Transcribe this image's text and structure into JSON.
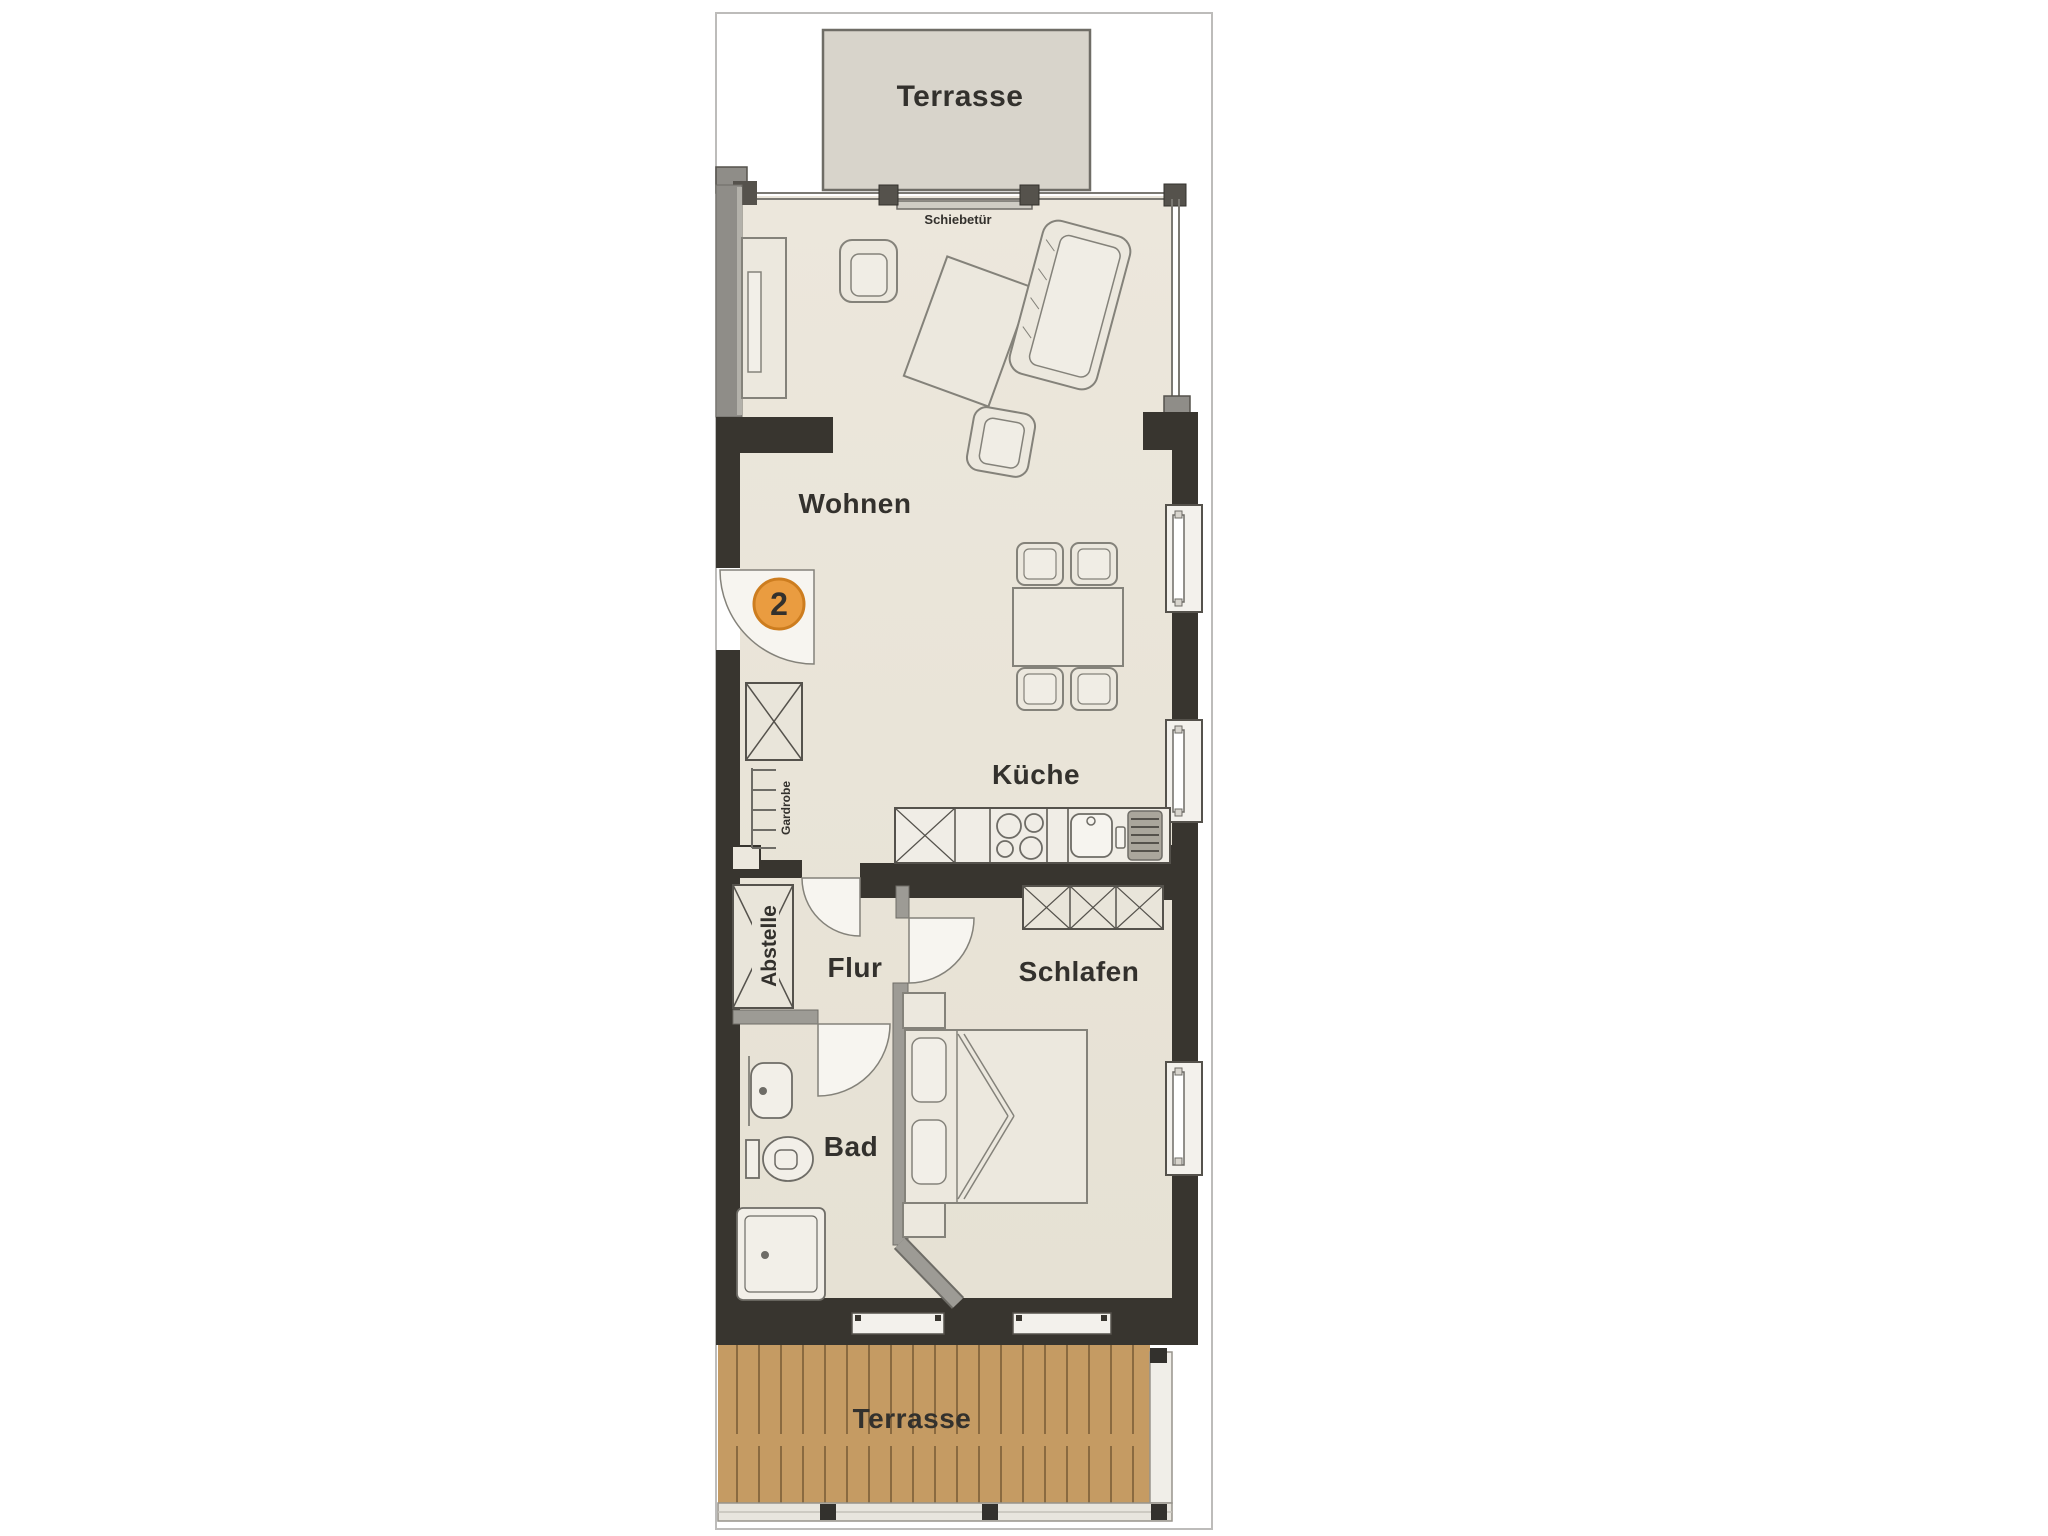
{
  "palette": {
    "wall_dark": "#38352f",
    "wall_gray": "#8f8d88",
    "partition_gray": "#9d9b95",
    "floor_cream": "#eae5da",
    "terrace_gray": "#d8d4cb",
    "terrace_wood": "#c59b63",
    "wood_plank_line": "#8a6a40",
    "badge_orange": "#ea9c40",
    "badge_ring": "#cd7d1f",
    "label_ink": "#33312d"
  },
  "plan": {
    "badge": "2",
    "rooms": {
      "terrace_top": "Terrasse",
      "living": "Wohnen",
      "kitchen": "Küche",
      "hall": "Flur",
      "bedroom": "Schlafen",
      "bath": "Bad",
      "storage": "Abstelle",
      "terrace_bottom": "Terrasse"
    },
    "annotations": {
      "sliding_door": "Schiebetür",
      "coat_rack": "Gardrobe"
    }
  }
}
